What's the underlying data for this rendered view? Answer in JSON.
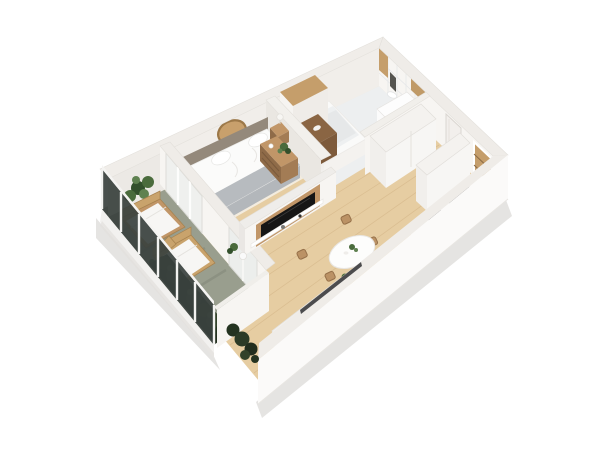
{
  "scene": {
    "label": "3D isometric floor plan render of a one-bedroom apartment with balcony",
    "colors": {
      "bg": "#ffffff",
      "wall_face": "#f7f5f2",
      "wall_face_dim": "#f1eeea",
      "wall_shade": "#eae7e2",
      "wall_top": "#efece8",
      "wall_outer": "#fbfaf9",
      "wall_edge": "#e3e0db",
      "wood_floor": "#e6cda2",
      "plank_line": "#d6b88b",
      "bathroom_floor": "#edeff0",
      "tile_line": "#e4e6e8",
      "bedroom_rug": "#f3ecdf",
      "balcony_floor": "#999e8e",
      "balcony_shadow": "#7e8374",
      "railing_panel": "#3a423e",
      "railing_post": "#f2f2f0",
      "hedge_dark": "#222e1e",
      "hedge_mid": "#32422a",
      "hedge_light": "#46573a",
      "wood_furniture": "#c19668",
      "wood_mid": "#a37c55",
      "wood_dark": "#8f6b48",
      "wood_deep": "#6f4f33",
      "headboard": "#94897b",
      "linen": "#fbfbfa",
      "throw_gray": "#b7bbbf",
      "pillow": "#ffffff",
      "tv_black": "#161616",
      "appliance_dark": "#202022",
      "glass_dark": "#2f3032",
      "appliance_white": "#fbfbfb",
      "plant_dark": "#33502c",
      "plant_mid": "#4a6b3c",
      "plant_light": "#5f8150",
      "pot_white": "#f6f5f3",
      "mirror_tan": "#c8a06c",
      "mirror_rim": "#9c7848",
      "niche_wood": "#c59e6b",
      "shadow": "#bfbcb8"
    },
    "rooms": [
      {
        "id": "bathroom",
        "label": "Bathroom",
        "items": [
          "bathtub",
          "washing machine",
          "toilet",
          "wood shelf unit",
          "tall cabinet",
          "wall mirror",
          "tiled wall"
        ]
      },
      {
        "id": "hallway",
        "label": "Entrance hall",
        "items": [
          "entrance door",
          "double wardrobe",
          "tall cabinet",
          "storage niche"
        ]
      },
      {
        "id": "bedroom",
        "label": "Bedroom",
        "items": [
          "double bed",
          "headboard",
          "two pillows",
          "gray throw",
          "nightstand left",
          "nightstand right",
          "table lamps",
          "round wall mirror",
          "dresser with plant",
          "curtained balcony door"
        ]
      },
      {
        "id": "living_kitchen",
        "label": "Living room with kitchen",
        "items": [
          "TV half wall",
          "TV",
          "media shelf",
          "sofa",
          "window",
          "dining table",
          "four wooden chairs",
          "kitchen counter",
          "cooktop",
          "sink"
        ]
      },
      {
        "id": "balcony",
        "label": "Balcony",
        "items": [
          "two wooden loungers",
          "side table",
          "large potted plant",
          "hedge",
          "glass railing with white posts"
        ]
      }
    ]
  }
}
